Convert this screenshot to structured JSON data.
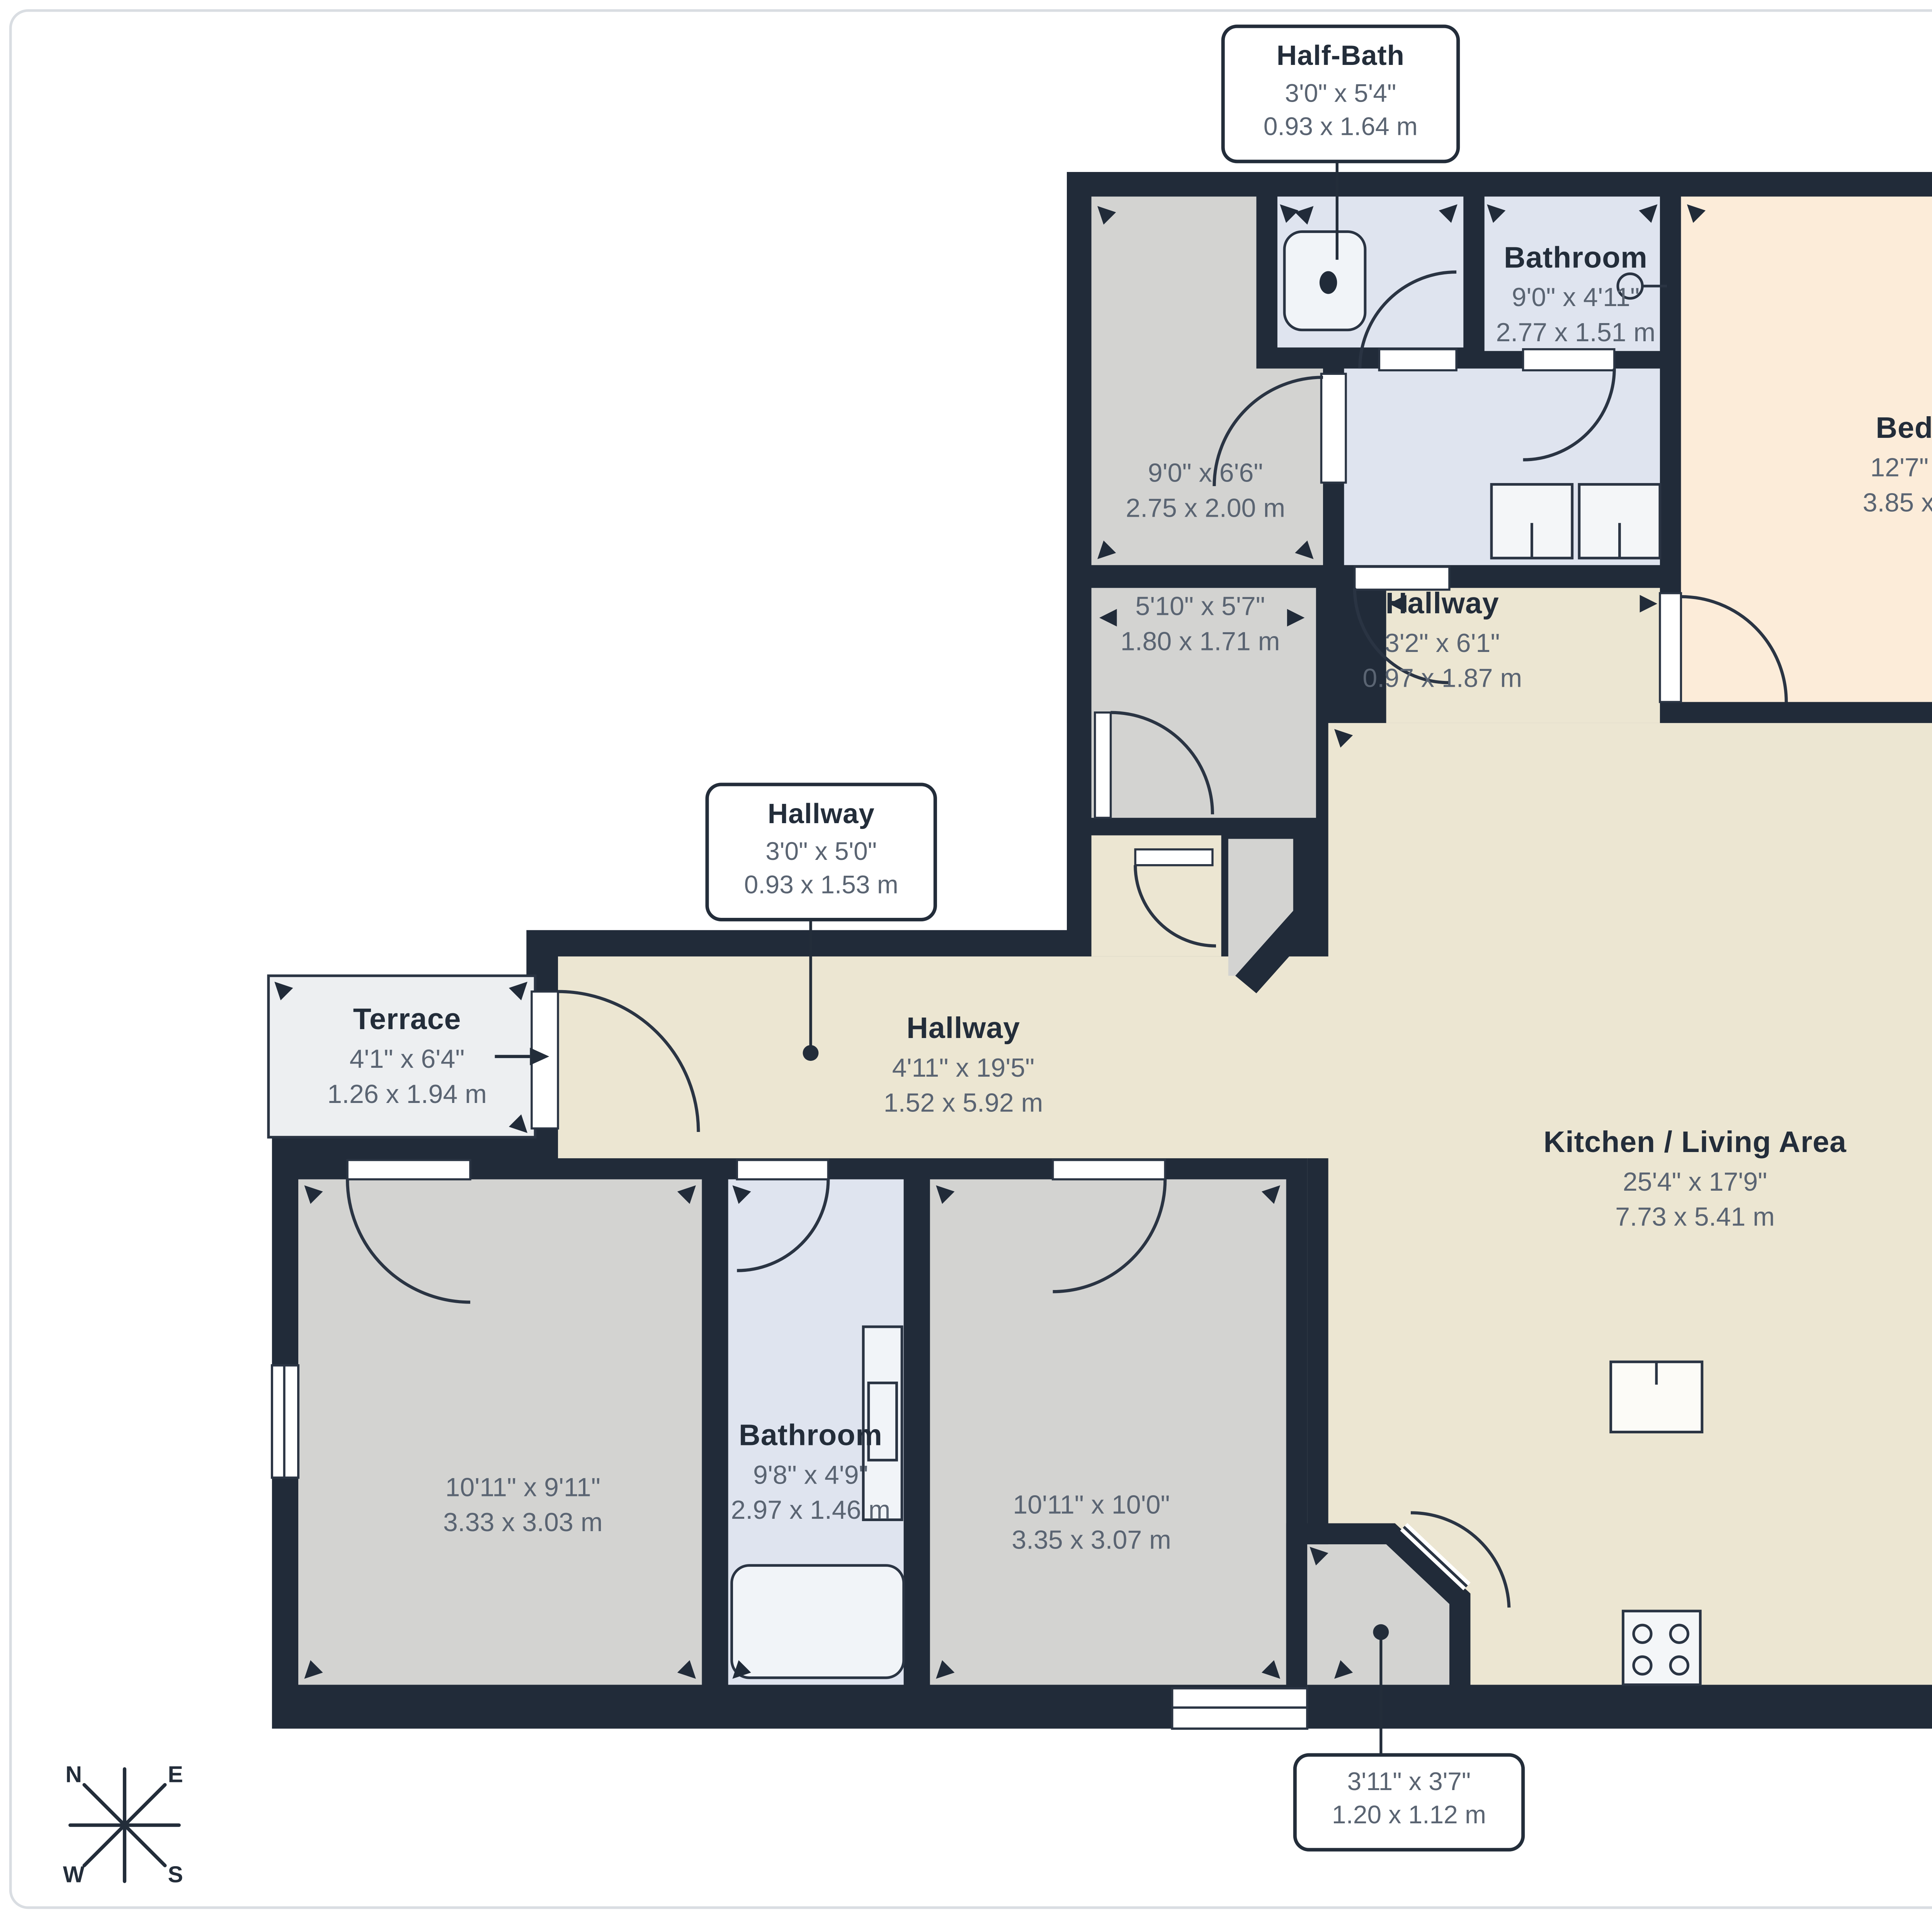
{
  "document_type": "floorplan",
  "colors": {
    "wall": "#212b39",
    "floor_main": "#ece6d2",
    "floor_bedroom": "#fcecd9",
    "floor_room_gray": "#d3d3d1",
    "floor_bathroom": "#dfe4ef",
    "floor_terrace": "#edeff1",
    "label_name": "#232d3a",
    "label_dims": "#5a6472"
  },
  "rooms": {
    "half_bath_callout": {
      "name": "Half-Bath",
      "imperial": "3'0\" x 5'4\"",
      "metric": "0.93 x 1.64 m"
    },
    "bathroom_top": {
      "name": "Bathroom",
      "imperial": "9'0\" x 4'11\"",
      "metric": "2.77 x 1.51 m"
    },
    "bedroom": {
      "name": "Bedroom",
      "imperial": "12'7\" x 13'0\"",
      "metric": "3.85 x 3.98 m"
    },
    "storage_a": {
      "imperial": "9'0\" x 6'6\"",
      "metric": "2.75 x 2.00 m"
    },
    "storage_b": {
      "imperial": "5'10\" x 5'7\"",
      "metric": "1.80 x 1.71 m"
    },
    "hallway_small": {
      "name": "Hallway",
      "imperial": "3'2\" x 6'1\"",
      "metric": "0.97 x 1.87 m"
    },
    "hallway_callout": {
      "name": "Hallway",
      "imperial": "3'0\" x 5'0\"",
      "metric": "0.93 x 1.53 m"
    },
    "terrace_left": {
      "name": "Terrace",
      "imperial": "4'1\" x 6'4\"",
      "metric": "1.26 x 1.94 m"
    },
    "hallway_main": {
      "name": "Hallway",
      "imperial": "4'11\" x 19'5\"",
      "metric": "1.52 x 5.92 m"
    },
    "kitchen_living": {
      "name": "Kitchen / Living Area",
      "imperial": "25'4\" x 17'9\"",
      "metric": "7.73 x 5.41 m"
    },
    "terrace_right_callout": {
      "name": "Terrace",
      "imperial": "13'7\" x 4'11\"",
      "metric": "4.15 x 1.52 m"
    },
    "bedroom_bottom_left": {
      "imperial": "10'11\" x 9'11\"",
      "metric": "3.33 x 3.03 m"
    },
    "bathroom_bottom": {
      "name": "Bathroom",
      "imperial": "9'8\" x 4'9\"",
      "metric": "2.97 x 1.46 m"
    },
    "bedroom_bottom_right": {
      "imperial": "10'11\" x 10'0\"",
      "metric": "3.35 x 3.07 m"
    },
    "entry_vestibule_callout": {
      "imperial": "3'11\" x 3'7\"",
      "metric": "1.20 x 1.12 m"
    }
  },
  "compass": {
    "n": "N",
    "e": "E",
    "w": "W",
    "s": "S"
  }
}
